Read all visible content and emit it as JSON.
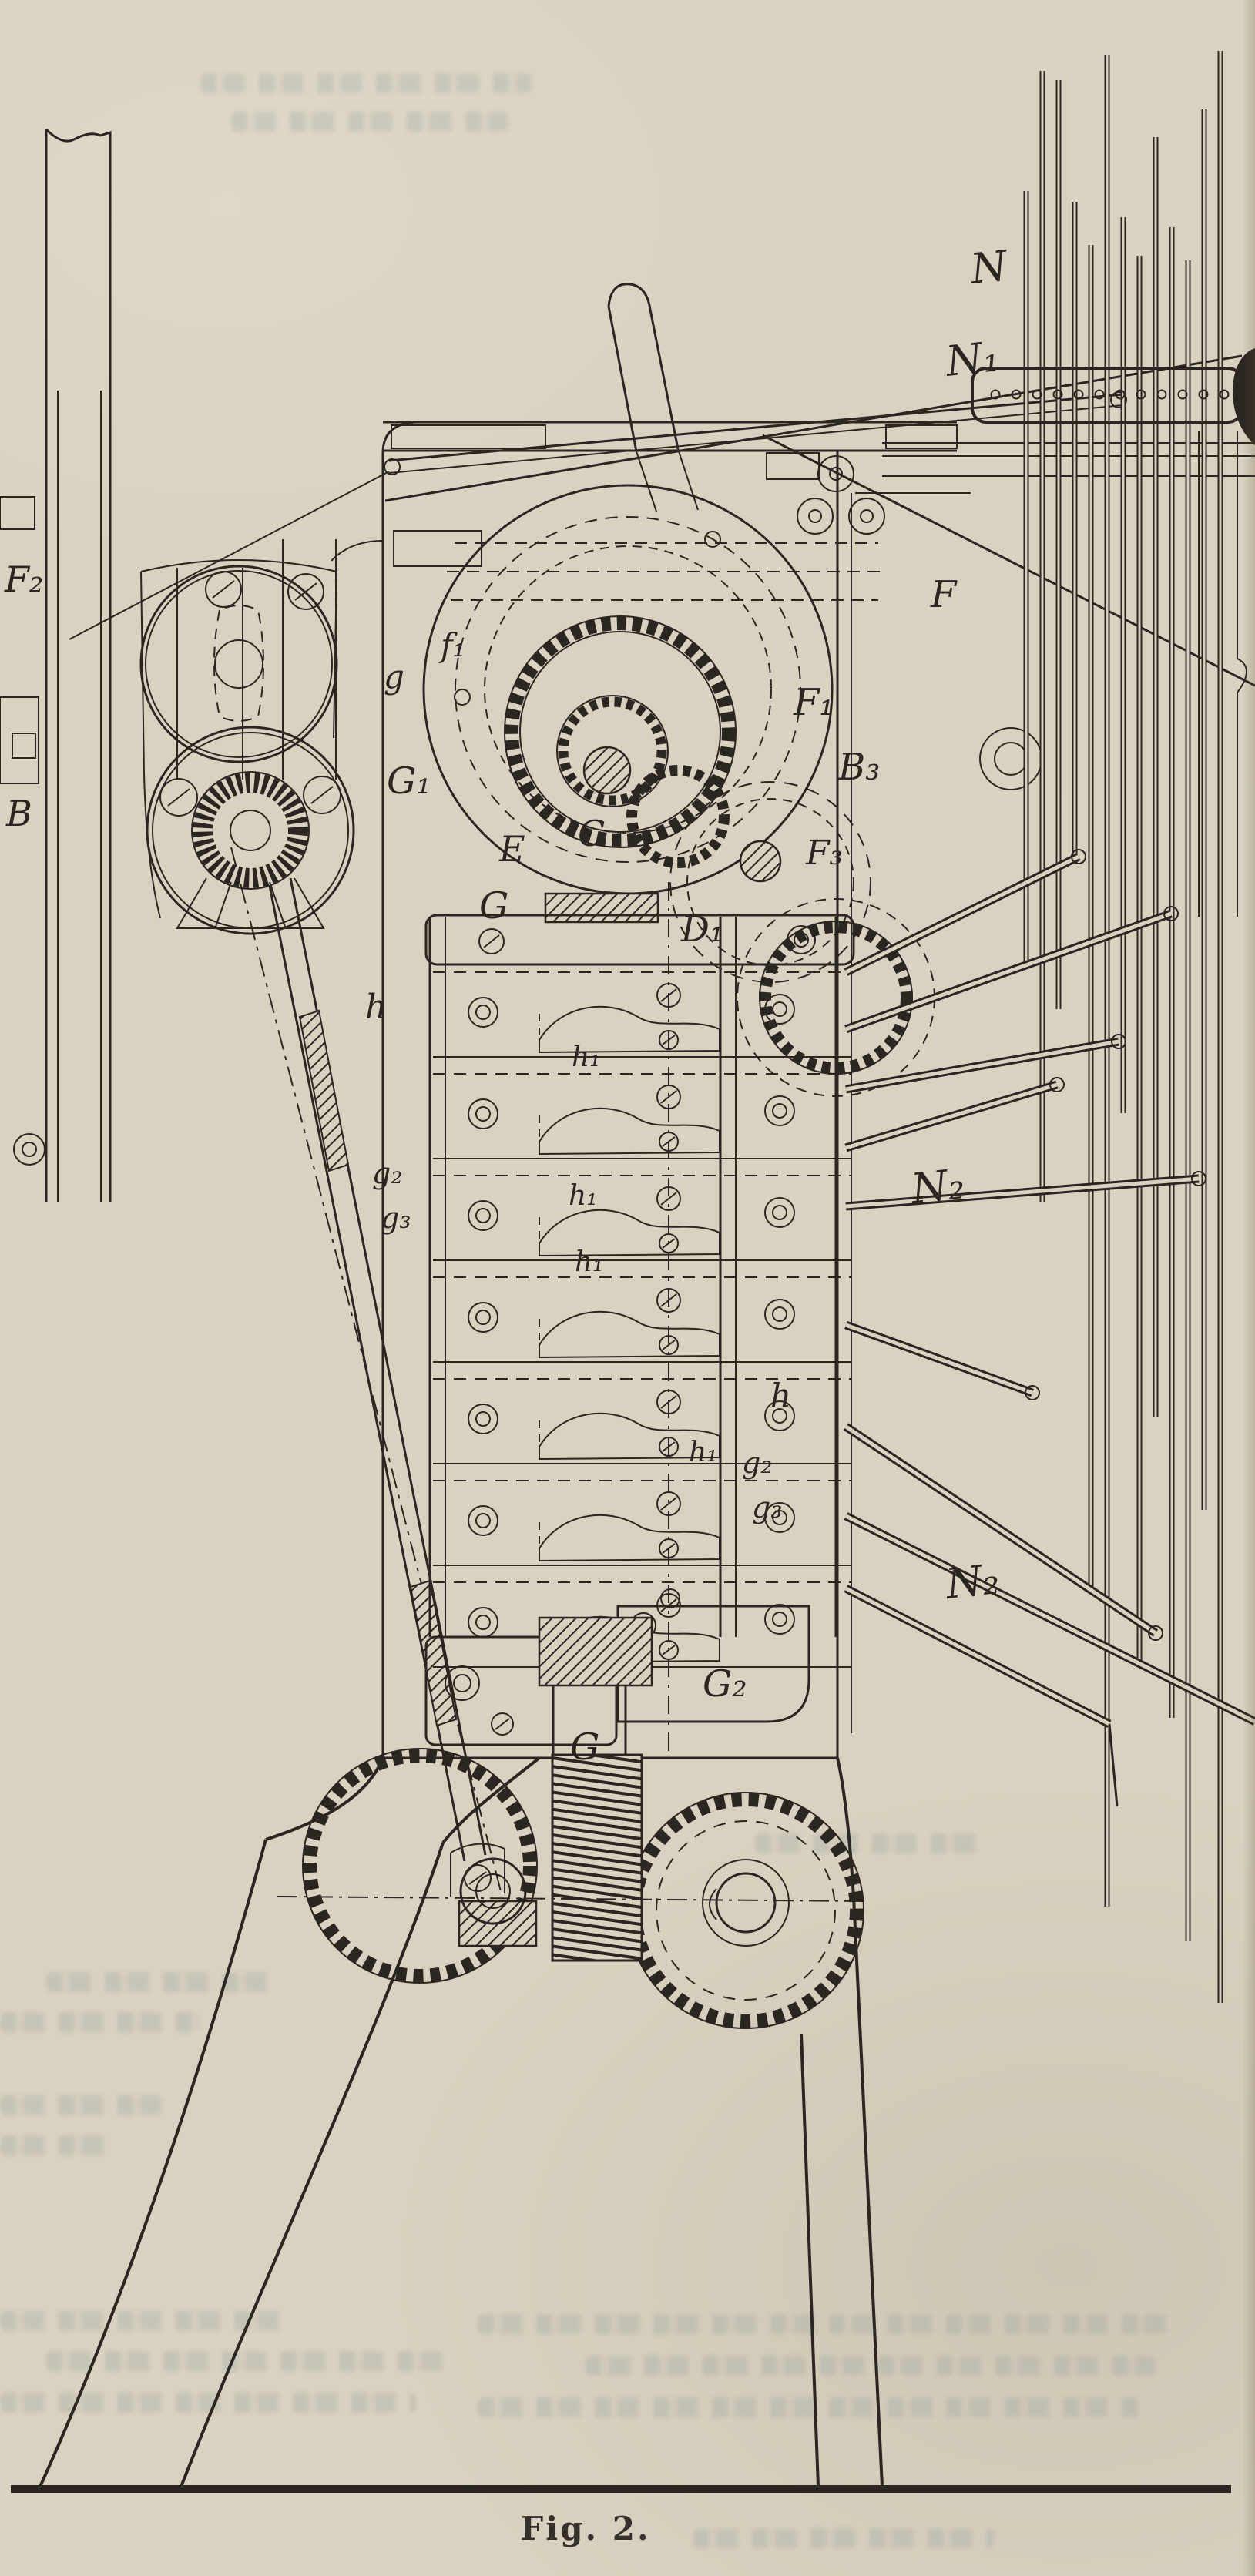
{
  "page": {
    "kind": "scanned technical figure from an old printed book",
    "paper_color": "#d9d2c0",
    "ink_color": "#2b2620",
    "bleedthrough_color": "#7a8a94"
  },
  "figure": {
    "caption": "Fig. 2."
  },
  "labels": [
    {
      "t": "N"
    },
    {
      "t": "N₁"
    },
    {
      "t": "N₂"
    },
    {
      "t": "N₂"
    },
    {
      "t": "F₂"
    },
    {
      "t": "B"
    },
    {
      "t": "f₁"
    },
    {
      "t": "g"
    },
    {
      "t": "G₁"
    },
    {
      "t": "E"
    },
    {
      "t": "C"
    },
    {
      "t": "G"
    },
    {
      "t": "D₁"
    },
    {
      "t": "F₁"
    },
    {
      "t": "B₃"
    },
    {
      "t": "F"
    },
    {
      "t": "F₃"
    },
    {
      "t": "h"
    },
    {
      "t": "h₁"
    },
    {
      "t": "h₁"
    },
    {
      "t": "h₁"
    },
    {
      "t": "h₁"
    },
    {
      "t": "h"
    },
    {
      "t": "g₂"
    },
    {
      "t": "g₃"
    },
    {
      "t": "g₂"
    },
    {
      "t": "g₃"
    },
    {
      "t": "G₂"
    },
    {
      "t": "G"
    }
  ]
}
